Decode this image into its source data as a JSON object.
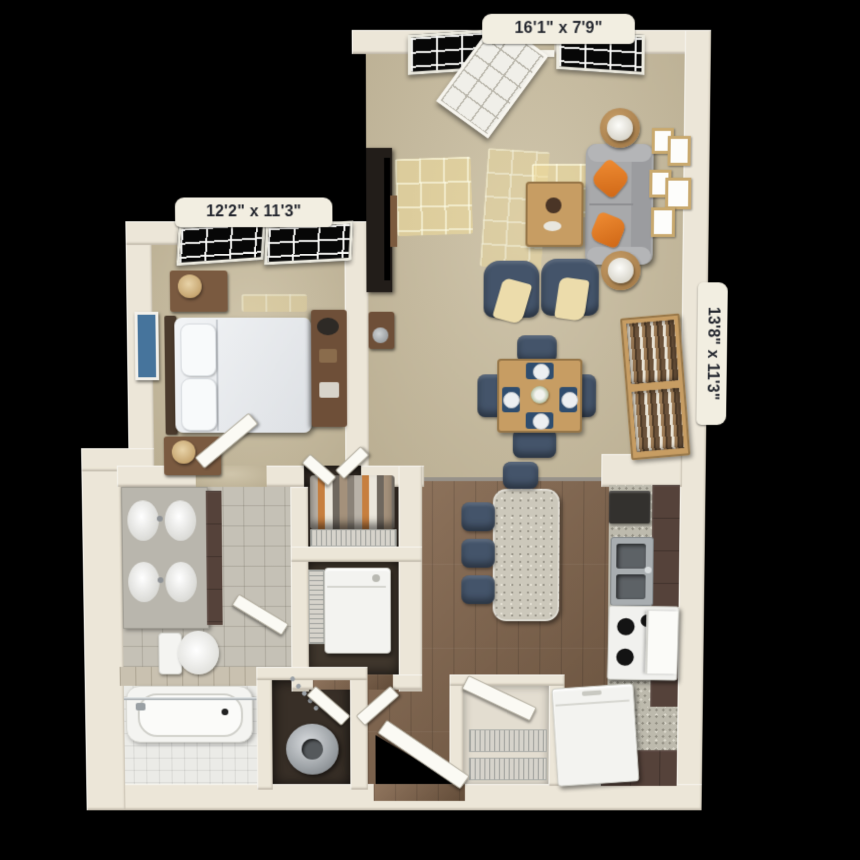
{
  "scene": {
    "type": "3d-floor-plan",
    "description": "Top-down 3D rendering of a one-bedroom, one-bath apartment floor plan on a black background",
    "background_color": "#000000"
  },
  "labels": {
    "living": "16'1\" x 7'9\"",
    "bedroom": "12'2\" x 11'3\"",
    "kitchen": "13'8\" x 11'3\""
  },
  "rooms": [
    {
      "name": "living-dining-room",
      "dimensions": "16'1\" x 7'9\"",
      "floor": "carpet",
      "furniture": [
        "sofa with orange pillows",
        "two side tables with lamps",
        "coffee table",
        "two accent chairs with throws",
        "dining table with four chairs and place settings",
        "bookcase",
        "tv console",
        "wall art frames",
        "two windows",
        "open french door"
      ]
    },
    {
      "name": "bedroom",
      "dimensions": "12'2\" x 11'3\"",
      "floor": "carpet",
      "furniture": [
        "bed with white duvet and pillows",
        "headboard",
        "two nightstands with lamps",
        "dresser desk",
        "framed wall art",
        "two windows"
      ]
    },
    {
      "name": "kitchen",
      "dimensions": "13'8\" x 11'3\"",
      "floor": "wood",
      "furniture": [
        "island with granite top",
        "four navy bar stools",
        "double sink",
        "range stove",
        "microwave",
        "refrigerator",
        "L-shaped counters with brown cabinets"
      ]
    },
    {
      "name": "bathroom",
      "floor": "tile",
      "furniture": [
        "double vanity with sinks",
        "toilet",
        "bathtub with shower rod"
      ]
    },
    {
      "name": "closets",
      "furniture": [
        "hanging clothes closet",
        "stacked washer closet",
        "water-heater utility closet",
        "pantry with wire shelves"
      ]
    }
  ],
  "colors": {
    "wall": "#ece6d8",
    "carpet": "#c8bc9f",
    "wood_floor": "#84664c",
    "bath_tile": "#c5c1b6",
    "tub_tile": "#ebebe7",
    "cabinet_brown": "#55423a",
    "granite": "#bdbaad",
    "navy_seat": "#44546a",
    "sofa_gray": "#a8a9ab",
    "accent_orange": "#e0762a",
    "wood_furniture": "#c79d63",
    "label_background": "#f2eee1",
    "label_text": "#23262e"
  }
}
